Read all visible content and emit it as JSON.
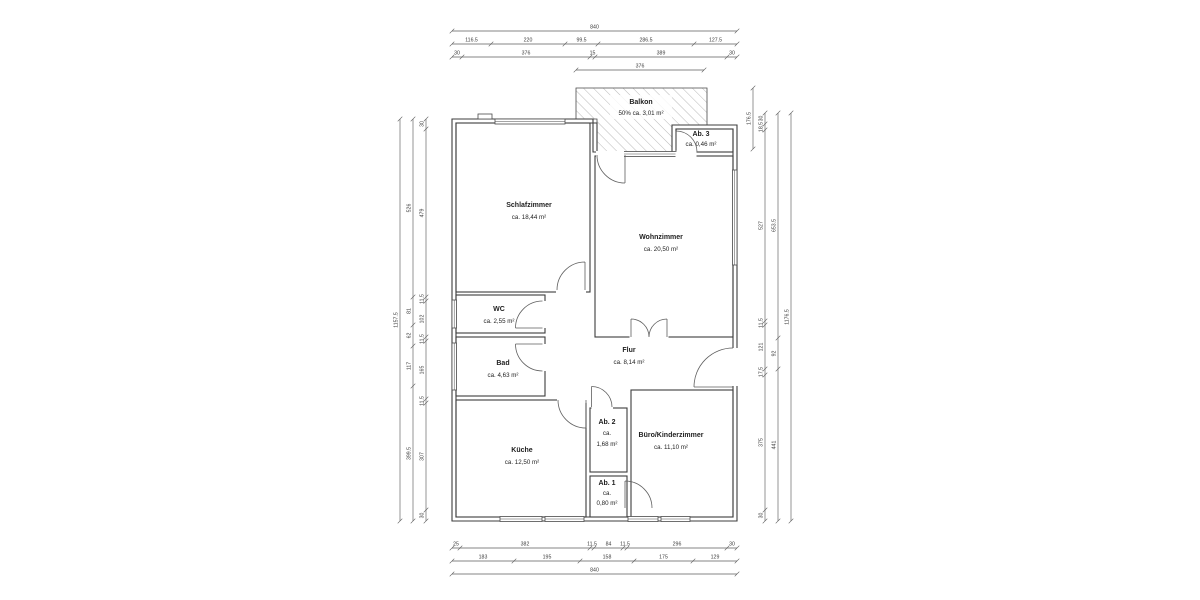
{
  "plan": {
    "rooms": {
      "balkon": {
        "name": "Balkon",
        "area": "50% ca. 3,01 m²"
      },
      "ab3": {
        "name": "Ab. 3",
        "area": "ca. 0,46 m²"
      },
      "schlafzimmer": {
        "name": "Schlafzimmer",
        "area": "ca. 18,44 m²"
      },
      "wohnzimmer": {
        "name": "Wohnzimmer",
        "area": "ca. 20,50 m²"
      },
      "wc": {
        "name": "WC",
        "area": "ca. 2,55 m²"
      },
      "bad": {
        "name": "Bad",
        "area": "ca. 4,63 m²"
      },
      "flur": {
        "name": "Flur",
        "area": "ca. 8,14 m²"
      },
      "kueche": {
        "name": "Küche",
        "area": "ca. 12,50 m²"
      },
      "ab2": {
        "name": "Ab. 2",
        "area_line1": "ca.",
        "area_line2": "1,68 m²"
      },
      "ab1": {
        "name": "Ab. 1",
        "area_line1": "ca.",
        "area_line2": "0,80 m²"
      },
      "buero": {
        "name": "Büro/Kinderzimmer",
        "area": "ca. 11,10 m²"
      }
    },
    "dimensions": {
      "top": [
        [
          "840"
        ],
        [
          "116.5",
          "220",
          "99.5",
          "286.5",
          "127.5"
        ],
        [
          "30",
          "376",
          "15",
          "389",
          "30"
        ],
        [
          "376"
        ]
      ],
      "bottom": [
        [
          "25",
          "382",
          "11.5",
          "84",
          "11.5",
          "296",
          "30"
        ],
        [
          "183",
          "195",
          "158",
          "175",
          "129"
        ],
        [
          "840"
        ]
      ],
      "left": [
        [
          "1157.5"
        ],
        [
          "526",
          "81",
          "62",
          "117",
          "399.5"
        ],
        [
          "30",
          "479",
          "11.5",
          "102",
          "11.5",
          "165",
          "11.5",
          "307",
          "30"
        ]
      ],
      "right": [
        [
          "176.5"
        ],
        [
          "30",
          "18.5",
          "527",
          "11.5",
          "121",
          "17.5",
          "375",
          "30"
        ],
        [
          "653.5",
          "92",
          "441"
        ],
        [
          "1176.5"
        ]
      ]
    },
    "colors": {
      "walls": "#3d3d3d",
      "dimension_lines": "#5c5c5c",
      "hatch": "#b9b9b9",
      "background": "#ffffff"
    }
  }
}
